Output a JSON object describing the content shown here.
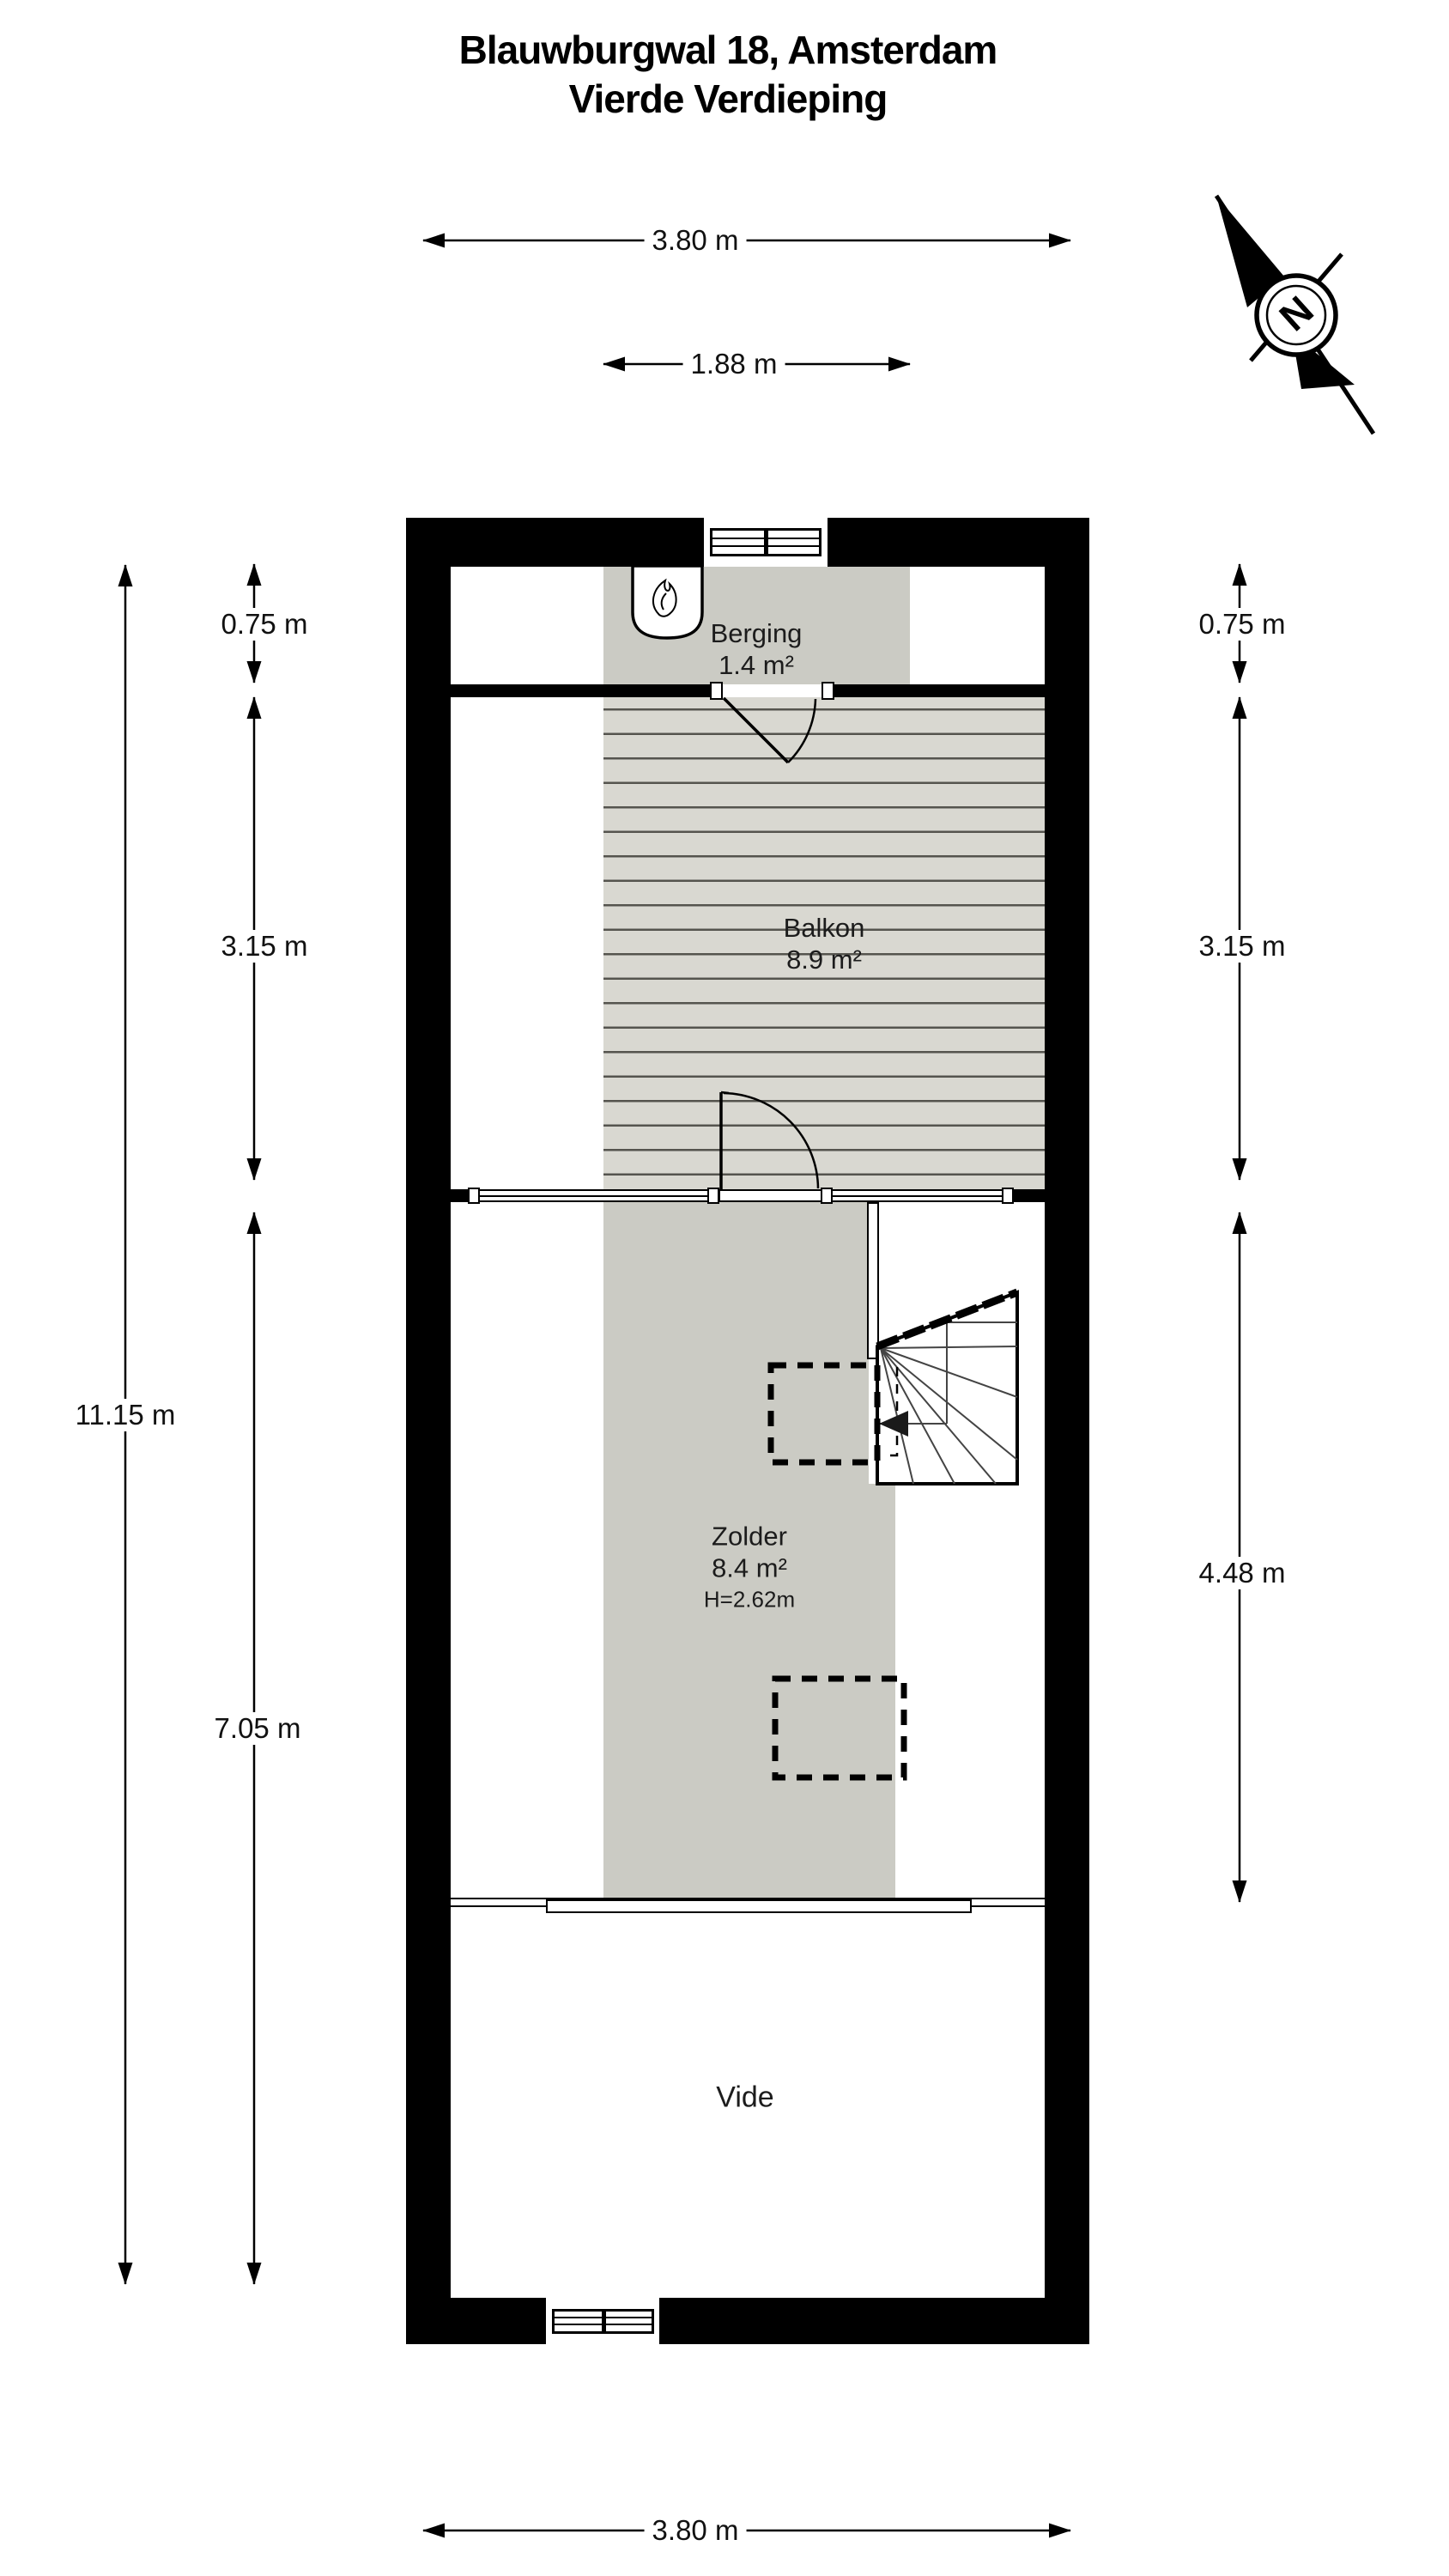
{
  "title": {
    "line1": "Blauwburgwal 18, Amsterdam",
    "line2": "Vierde Verdieping"
  },
  "compass": {
    "north_label": "N"
  },
  "rooms": {
    "berging": {
      "name": "Berging",
      "area": "1.4 m²"
    },
    "balkon": {
      "name": "Balkon",
      "area": "8.9 m²"
    },
    "zolder": {
      "name": "Zolder",
      "area": "8.4 m²",
      "ceiling_height": "H=2.62m"
    },
    "vide": {
      "name": "Vide"
    }
  },
  "dimensions": {
    "top_width": "3.80 m",
    "berging_width": "1.88 m",
    "bottom_width": "3.80 m",
    "left_total_height": "11.15 m",
    "left_berging_depth": "0.75 m",
    "left_balkon_depth": "3.15 m",
    "left_lower_depth": "7.05 m",
    "right_berging_depth": "0.75 m",
    "right_balkon_depth": "3.15 m",
    "right_zolder_depth": "4.48 m"
  },
  "colors": {
    "wall": "#000000",
    "floor_gray": "#cbcbc4",
    "deck_gray": "#d9d8d1",
    "deck_stripe": "#55544e",
    "background": "#ffffff"
  }
}
